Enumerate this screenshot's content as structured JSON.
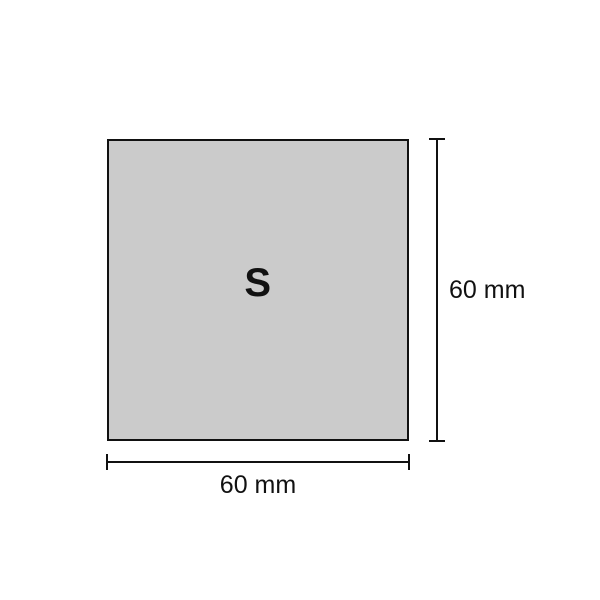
{
  "diagram": {
    "shape_label": "S",
    "width_dimension_label": "60 mm",
    "height_dimension_label": "60 mm",
    "colors": {
      "background": "#ffffff",
      "shape_fill": "#cbcbcb",
      "line": "#111111",
      "text": "#111111"
    }
  }
}
